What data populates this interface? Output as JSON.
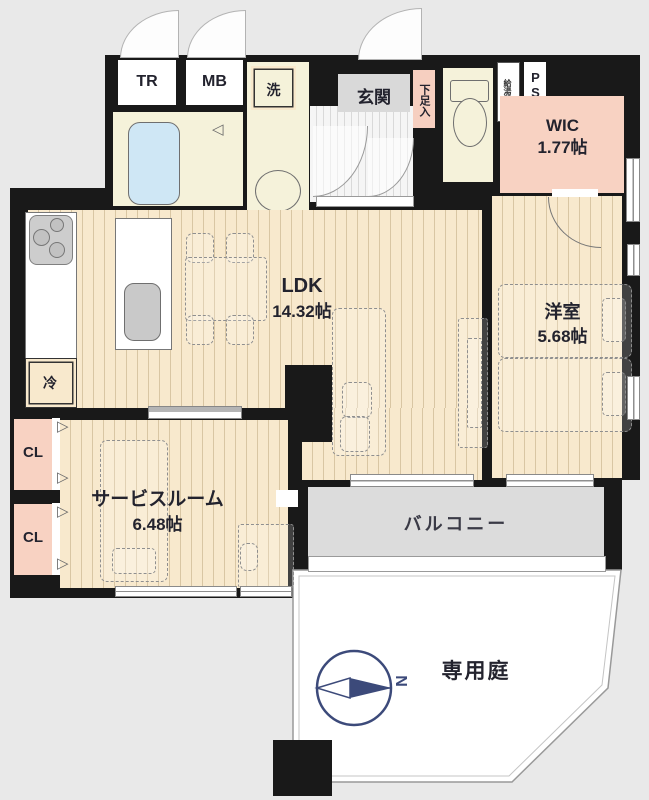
{
  "title": "マンション間取り図",
  "colors": {
    "background": "#e9e9e9",
    "wall": "#191919",
    "wood_floor": "#f8e9cd",
    "cream_floor": "#f5f2da",
    "pink_room": "#f8d2c2",
    "balcony": "#dcdcdc",
    "bathtub": "#cfe7f5",
    "compass": "#3c4a7a"
  },
  "rooms": {
    "tr": {
      "label": "TR"
    },
    "mb": {
      "label": "MB"
    },
    "washer": {
      "label": "洗"
    },
    "entrance": {
      "label": "玄関"
    },
    "shoe_cabinet": {
      "label": "下足入"
    },
    "water_heater": {
      "label": "給湯器"
    },
    "pipe_space": {
      "label": "PS"
    },
    "wic": {
      "name": "WIC",
      "area": "1.77帖"
    },
    "ldk": {
      "name": "LDK",
      "area": "14.32帖"
    },
    "refrigerator": {
      "label": "冷"
    },
    "western_room": {
      "name": "洋室",
      "area": "5.68帖"
    },
    "closet_upper": {
      "label": "CL"
    },
    "closet_lower": {
      "label": "CL"
    },
    "service_room": {
      "name": "サービスルーム",
      "area": "6.48帖"
    },
    "balcony": {
      "label": "バルコニー"
    },
    "private_garden": {
      "label": "専用庭"
    },
    "compass": {
      "north": "N"
    }
  }
}
